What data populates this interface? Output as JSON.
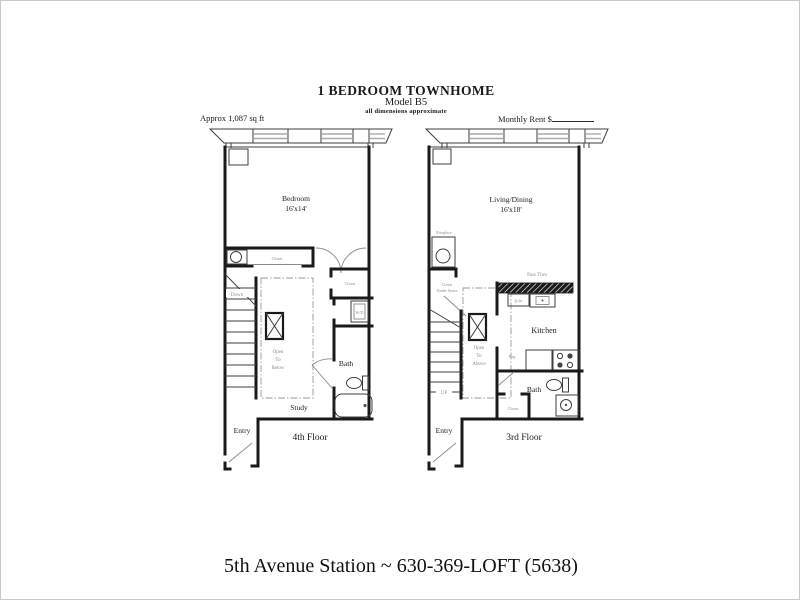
{
  "header": {
    "title": "1 BEDROOM TOWNHOME",
    "model": "Model B5",
    "disclaimer": "all dimensions approximate",
    "sqft": "Approx 1,087 sq ft",
    "rent_label": "Monthly Rent $"
  },
  "footer": {
    "text": "5th Avenue Station ~ 630-369-LOFT (5638)"
  },
  "colors": {
    "wall_ink": "#1a1a1a",
    "annotation_gray": "#8c8c8c",
    "window_gray": "#aaaaaa"
  },
  "floor4": {
    "floor_label": "4th Floor",
    "bedroom": "Bedroom",
    "bedroom_dim": "16'x14'",
    "closet_top": "Closet",
    "hall_closet": "Closet",
    "washer_dryer": "W/D",
    "down": "Down",
    "open_to": [
      "Open",
      "To",
      "Below"
    ],
    "bath": "Bath",
    "study": "Study",
    "entry": "Entry"
  },
  "floor3": {
    "floor_label": "3rd Floor",
    "living": "Living/Dining",
    "living_dim": "16'x18'",
    "fireplace": "Fireplace",
    "closet_under_stairs": [
      "Closet",
      "Under Stairs"
    ],
    "up": "UP",
    "open_to": [
      "Open",
      "To",
      "Above"
    ],
    "pass_thru": "Pass Thru",
    "dishwasher": "D/W",
    "kitchen": "Kitchen",
    "fridge": "Frig",
    "bath": "Bath",
    "closet": "Closet",
    "entry": "Entry"
  }
}
